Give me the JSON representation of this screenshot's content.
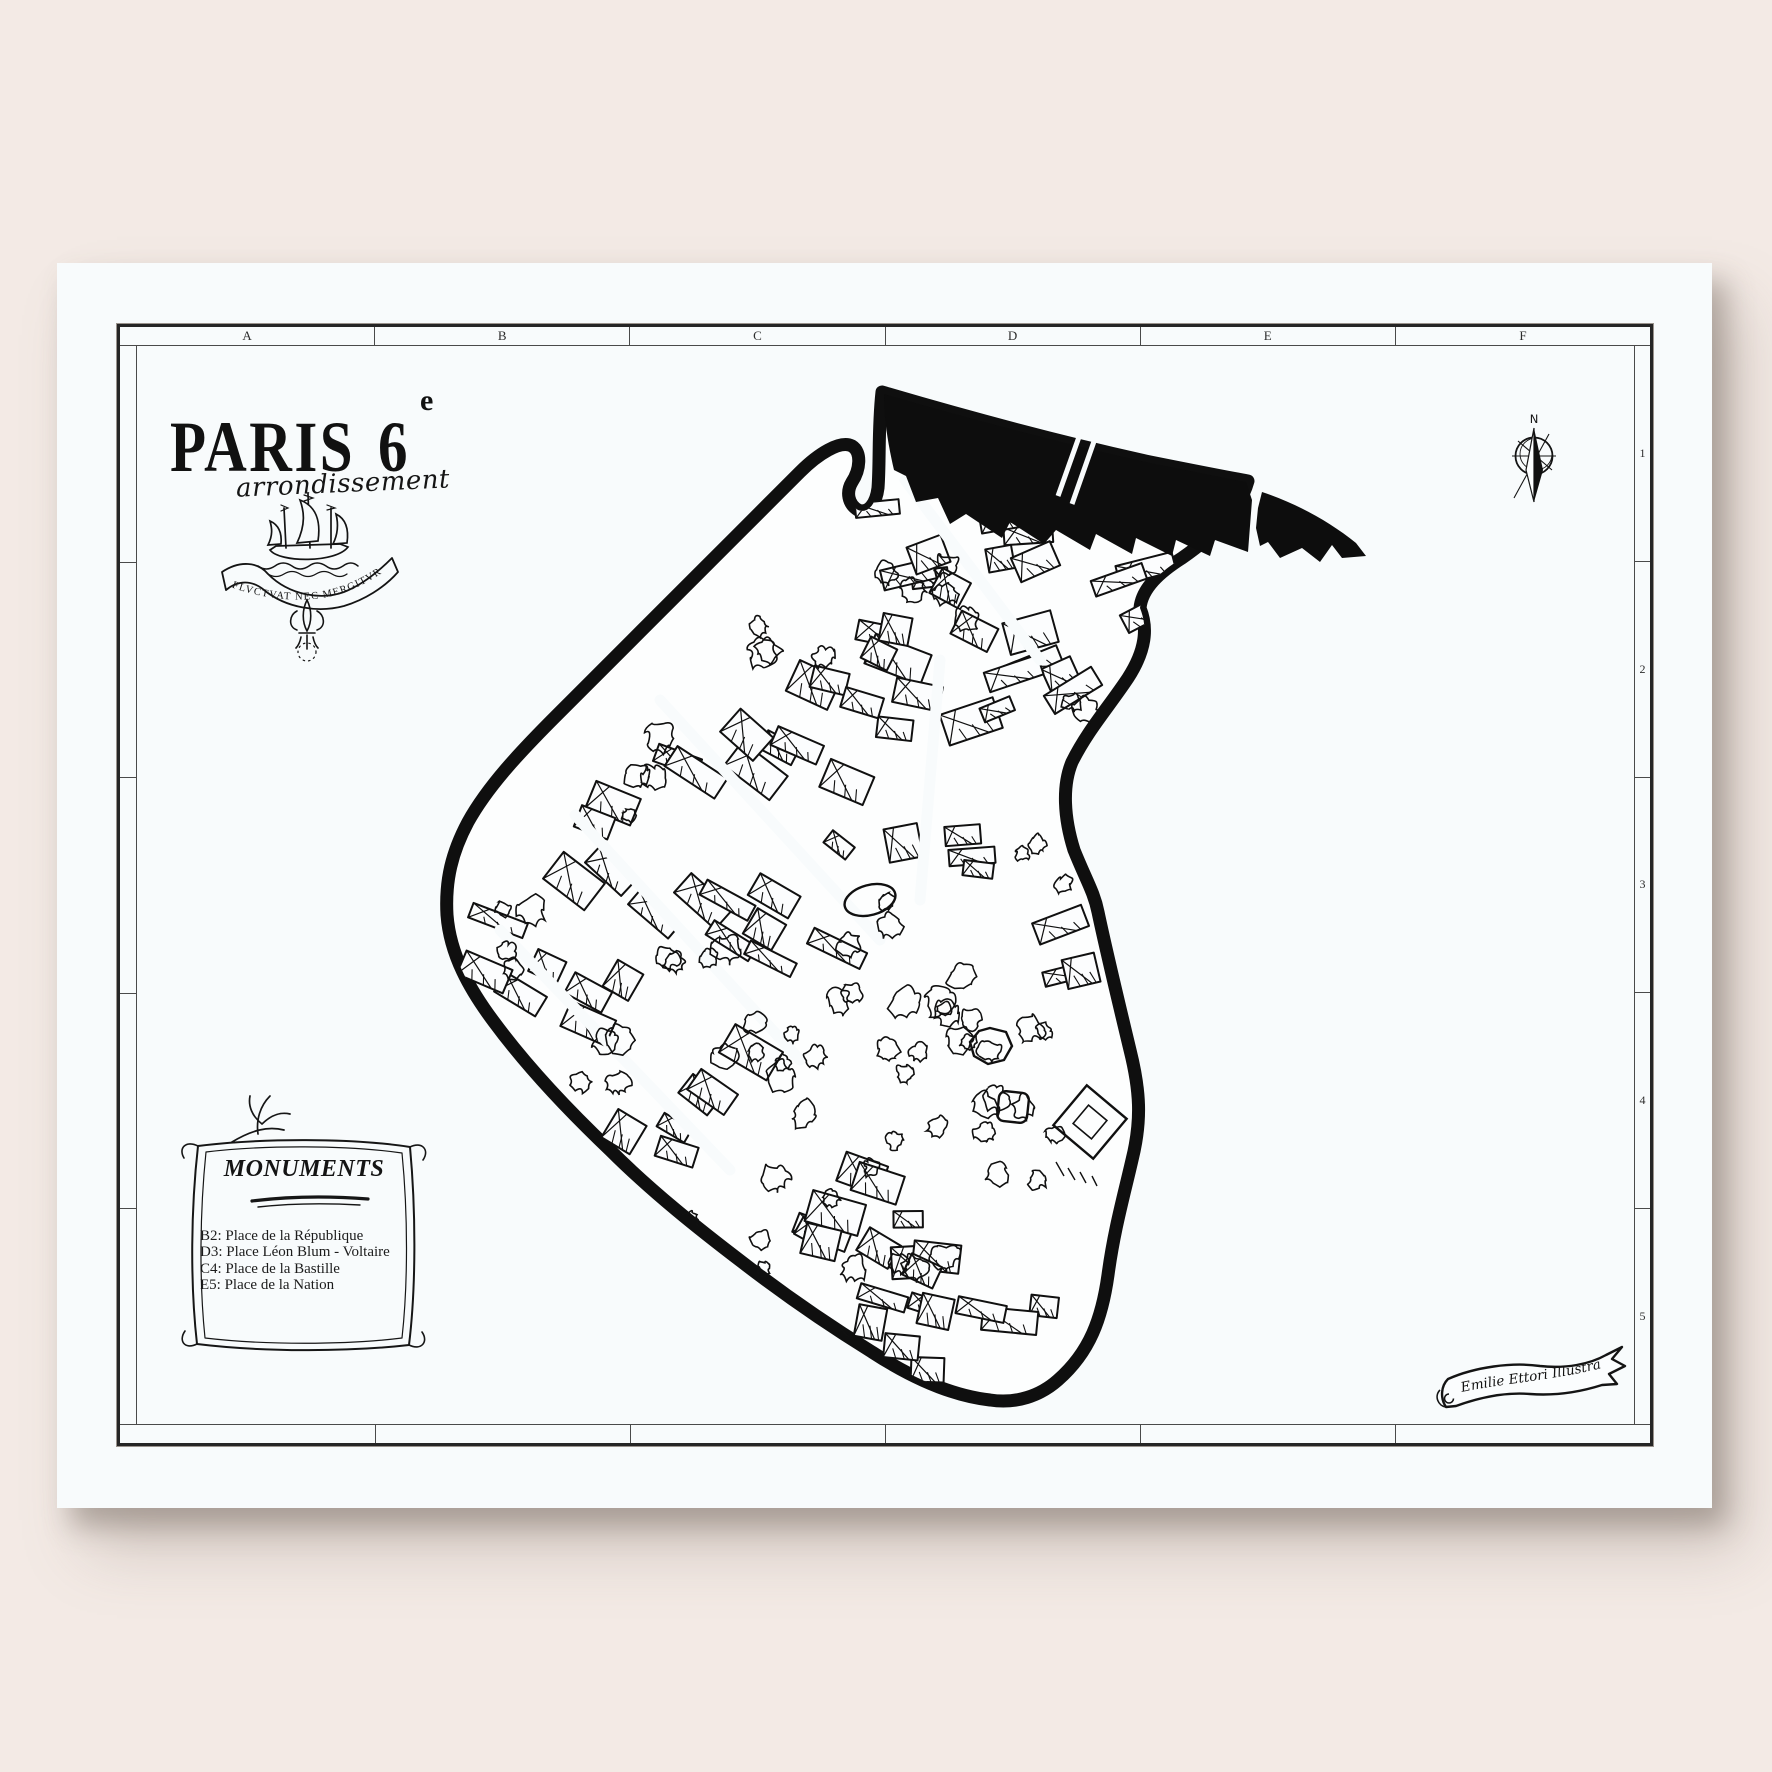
{
  "poster": {
    "title": {
      "city": "PARIS",
      "district_number": "6",
      "ordinal_suffix": "e",
      "subtitle": "arrondissement"
    },
    "emblem": {
      "motto": "FLVCTVAT NEC MERGITVR"
    },
    "grid": {
      "column_labels": [
        "A",
        "B",
        "C",
        "D",
        "E",
        "F"
      ],
      "row_labels": [
        "1",
        "2",
        "3",
        "4",
        "5"
      ]
    },
    "legend": {
      "heading": "MONUMENTS",
      "items": [
        {
          "ref": "B2",
          "label": "Place de la République"
        },
        {
          "ref": "D3",
          "label": "Place Léon Blum - Voltaire"
        },
        {
          "ref": "C4",
          "label": "Place de la Bastille"
        },
        {
          "ref": "E5",
          "label": "Place de la Nation"
        }
      ]
    },
    "compass": {
      "north_label": "N"
    },
    "credit": {
      "signature": "Emilie Ettori Illustration"
    }
  },
  "colors": {
    "background": "#f3eae5",
    "paper": "#f8fbfc",
    "ink": "#141414"
  }
}
